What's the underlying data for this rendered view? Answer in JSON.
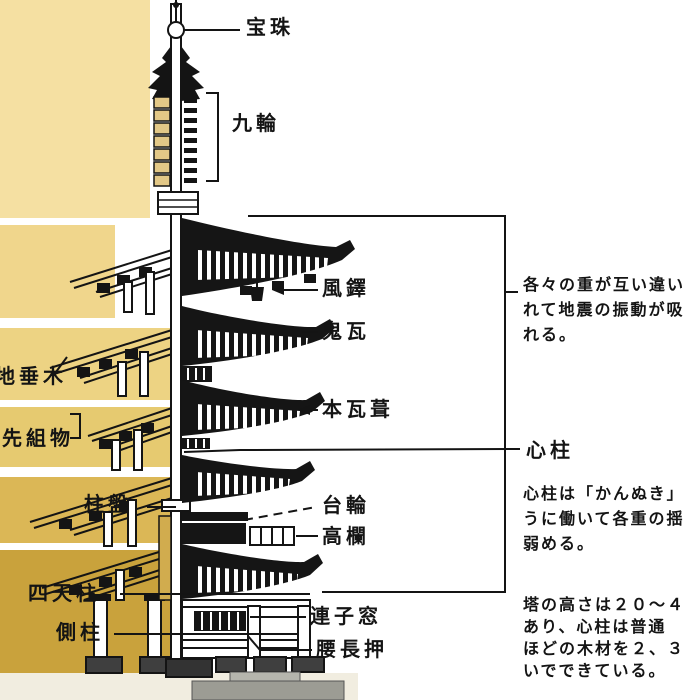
{
  "labels": {
    "hoju": "宝珠",
    "kurin": "九輪",
    "futaku": "風鐸",
    "onigawara": "鬼瓦",
    "hongawarabuki": "本瓦葺",
    "shinbashira": "心柱",
    "daiwa": "台輪",
    "koran": "高欄",
    "renjimado": "連子窓",
    "koshinageshi": "腰長押",
    "jidaruki": "地垂木",
    "sakigumimono": "先組物",
    "chuban": "柱盤",
    "shitenbashira": "四天柱",
    "gawabashira": "側柱"
  },
  "notes": {
    "sway": "各々の重が互い違い\nれて地震の振動が吸\nれる。",
    "shinbashira_role": "心柱は「かんぬき」\nうに働いて各重の揺\n弱める。",
    "height": "塔の高さは２０～４\nあり、心柱は普通\nほどの木材を２、３\nいでできている。"
  },
  "colors": {
    "band1": "#F5E0A2",
    "band2": "#F0D68C",
    "band3": "#EDD383",
    "band4": "#E6CA70",
    "band5": "#DBB756",
    "band6": "#C9A23C",
    "bottomStrip": "#F1EDE0",
    "ringBox": "#E3C887",
    "goldStrip": "#D1AC4E",
    "ink": "#141414"
  }
}
